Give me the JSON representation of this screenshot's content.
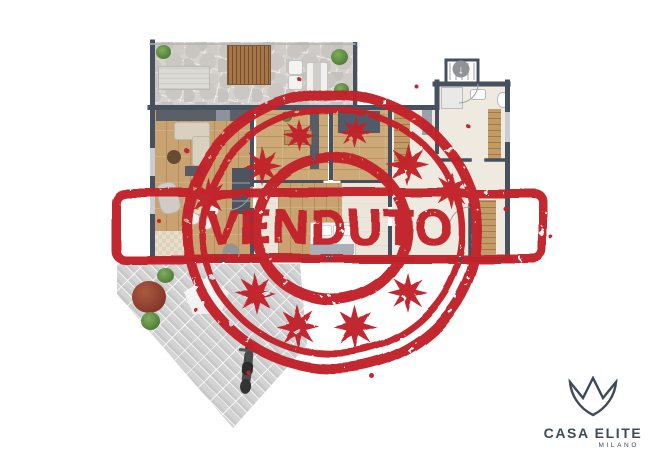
{
  "canvas": {
    "width": 650,
    "height": 459,
    "background": "#ffffff"
  },
  "stamp": {
    "text": "VENDUTO",
    "color": "#c2242a",
    "style": "distressed rubber stamp: double outer ellipse, inner ring, horizontal banner, eight-point starbursts"
  },
  "logo": {
    "brand": "CASA ELITE",
    "city": "MILANO",
    "color": "#3e4a59",
    "icon": "crown-icon"
  },
  "plan": {
    "icons": {
      "entrance_arrow": "↓",
      "nav_arrow": "←"
    },
    "colors": {
      "wall": "#47505e",
      "wood_floor": "#c9a271",
      "light_floor": "#ece6da",
      "terrace_stone": "#d6d3ce",
      "paving": "#d3d3d3",
      "greenery": "#527d39",
      "red_bush": "#8a3b2b"
    }
  }
}
